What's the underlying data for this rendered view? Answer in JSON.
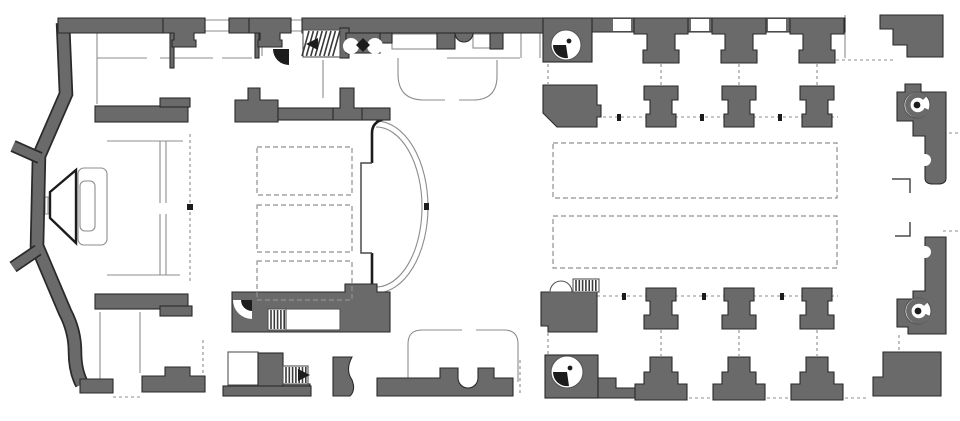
{
  "document": {
    "type": "architectural-floor-plan",
    "subject": "scanned church floor plan",
    "orientation": "apse-left-entrance-right"
  },
  "colors": {
    "background": "#ffffff",
    "wall_fill": "#6a6a6a",
    "wall_outline": "#2a2a2a",
    "thin_line": "#8c8c8c",
    "dark_line": "#1c1c1c",
    "hatch_line": "#3a3a3a"
  },
  "elements": {
    "piers": {
      "left_wall_tpier_x": [
        184,
        270
      ],
      "nave_top_wall_x": [
        661,
        739,
        817
      ],
      "nave_top_free_x": [
        661,
        739,
        817
      ],
      "nave_bottom_free_x": [
        661,
        739,
        817
      ],
      "nave_bottom_wall_x": [
        661,
        739,
        817
      ]
    },
    "spiral_stairs": [
      {
        "cx": 566,
        "cy": 45,
        "r": 15,
        "style": "wedge"
      },
      {
        "cx": 567,
        "cy": 372,
        "r": 16,
        "style": "wedge"
      },
      {
        "cx": 917,
        "cy": 105,
        "r": 13,
        "style": "curl"
      },
      {
        "cx": 918,
        "cy": 311,
        "r": 13,
        "style": "curl"
      }
    ],
    "pews": [
      {
        "x": 553,
        "y": 143,
        "w": 284,
        "h": 55
      },
      {
        "x": 553,
        "y": 216,
        "w": 284,
        "h": 52
      }
    ],
    "choir_stalls": [
      {
        "x": 257,
        "y": 147,
        "w": 95,
        "h": 48
      },
      {
        "x": 257,
        "y": 205,
        "w": 95,
        "h": 47
      },
      {
        "x": 257,
        "y": 261,
        "w": 95,
        "h": 39
      }
    ],
    "stairs": [
      {
        "name": "north-stair",
        "x": 303,
        "y": 30,
        "w": 37,
        "h": 27,
        "treads": "diag",
        "arrow": "left"
      },
      {
        "name": "south-stair",
        "x": 283,
        "y": 366,
        "w": 25,
        "h": 18,
        "treads": "vert",
        "arrow": "right"
      },
      {
        "name": "pulpit-stair",
        "x": 573,
        "y": 279,
        "w": 26,
        "h": 13,
        "treads": "vert",
        "arrow": "none"
      },
      {
        "name": "passage-stair",
        "x": 268,
        "y": 309,
        "w": 18,
        "h": 21,
        "treads": "vert",
        "arrow": "none"
      }
    ],
    "axis_ticks": [
      [
        617,
        114
      ],
      [
        700,
        114
      ],
      [
        778,
        114
      ],
      [
        622,
        293
      ],
      [
        702,
        293
      ],
      [
        780,
        293
      ]
    ],
    "arc": {
      "cx": 376,
      "cy": 207,
      "rx": 52,
      "ry": 86
    },
    "pier_link_dashes_top_y": [
      64,
      85
    ],
    "pier_link_dashes_bottom_y": [
      330,
      356
    ]
  }
}
